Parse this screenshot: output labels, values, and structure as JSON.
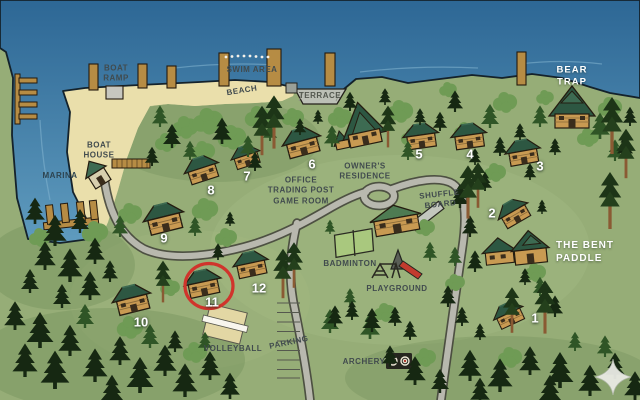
{
  "map": {
    "labels": {
      "boat_ramp": "BOAT\nRAMP",
      "swim_area": "SWIM AREA",
      "beach": "BEACH",
      "terrace": "TERRACE",
      "boat_house": "BOAT\nHOUSE",
      "marina": "MARINA",
      "bear_trap": "BEAR\nTRAP",
      "owners_residence": "OWNER'S\nRESIDENCE",
      "office": "OFFICE\nTRADING POST\nGAME ROOM",
      "shuffle_board": "SHUFFLE\nBOARD",
      "badminton": "BADMINTON",
      "playground": "PLAYGROUND",
      "bent_paddle": "THE BENT\nPADDLE",
      "volleyball": "VOLLEYBALL",
      "parking": "PARKING",
      "archery": "ARCHERY"
    },
    "cabins": [
      "1",
      "2",
      "3",
      "4",
      "5",
      "6",
      "7",
      "8",
      "9",
      "10",
      "11",
      "12"
    ],
    "highlighted_cabin": "11",
    "colors": {
      "water": "#3f7ba3",
      "grass": "#96ad77",
      "sand": "#eadfab",
      "road": "#b8b8ae",
      "cabin_roof": "#2d5742",
      "cabin_wall": "#c89a52",
      "highlight_ring": "#d0342c",
      "label_dark": "#414b4e",
      "label_light": "#ffffff"
    }
  }
}
